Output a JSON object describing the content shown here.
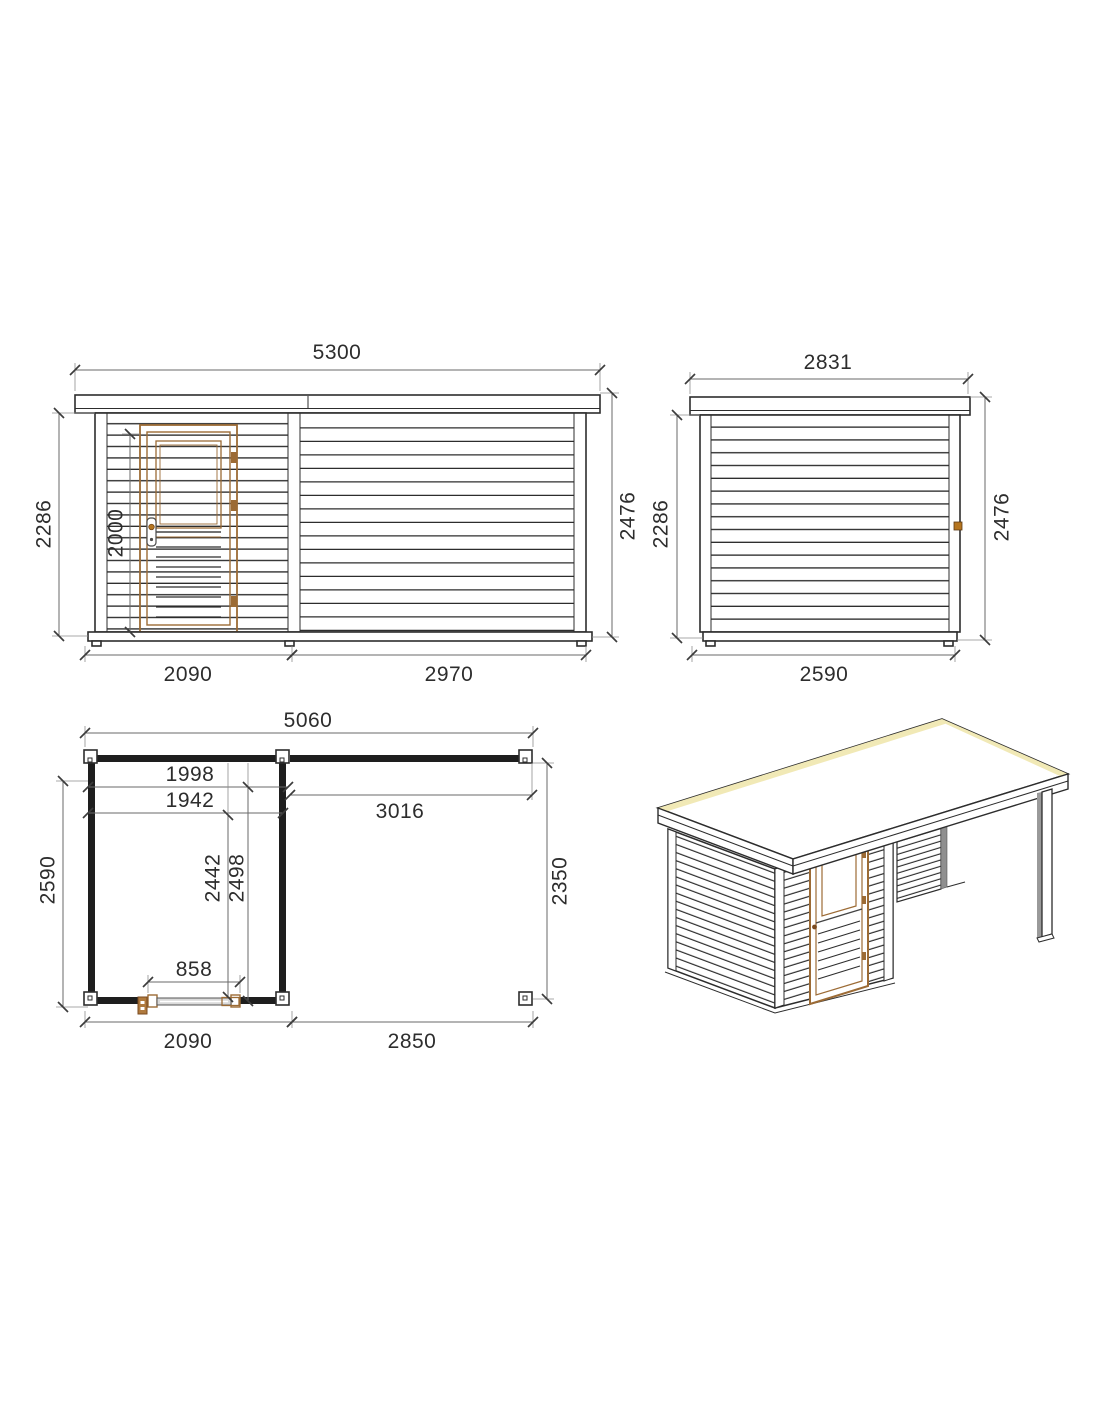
{
  "drawing": {
    "front_elevation": {
      "total_width": "5300",
      "wall_height": "2286",
      "door_height": "2000",
      "overall_height": "2476",
      "cabin_width": "2090",
      "annex_width": "2970"
    },
    "side_elevation": {
      "total_width": "2831",
      "wall_height": "2286",
      "overall_height": "2476",
      "base_depth": "2590"
    },
    "floor_plan": {
      "total_width": "5060",
      "cabin_inner_width_a": "1998",
      "cabin_inner_width_b": "1942",
      "annex_inner_width": "3016",
      "cabin_depth": "2590",
      "cabin_inner_depth_a": "2442",
      "cabin_inner_depth_b": "2498",
      "annex_depth": "2350",
      "door_width": "858",
      "cabin_width": "2090",
      "annex_width": "2850"
    },
    "colors": {
      "line": "#2d2d2d",
      "dimension_line": "#6a6a6a",
      "wood_brown": "#9c6b35",
      "hardware_orange": "#b5751f",
      "roof_highlight": "#f1e9b6",
      "shadow_gray": "#8f8f8f"
    }
  }
}
